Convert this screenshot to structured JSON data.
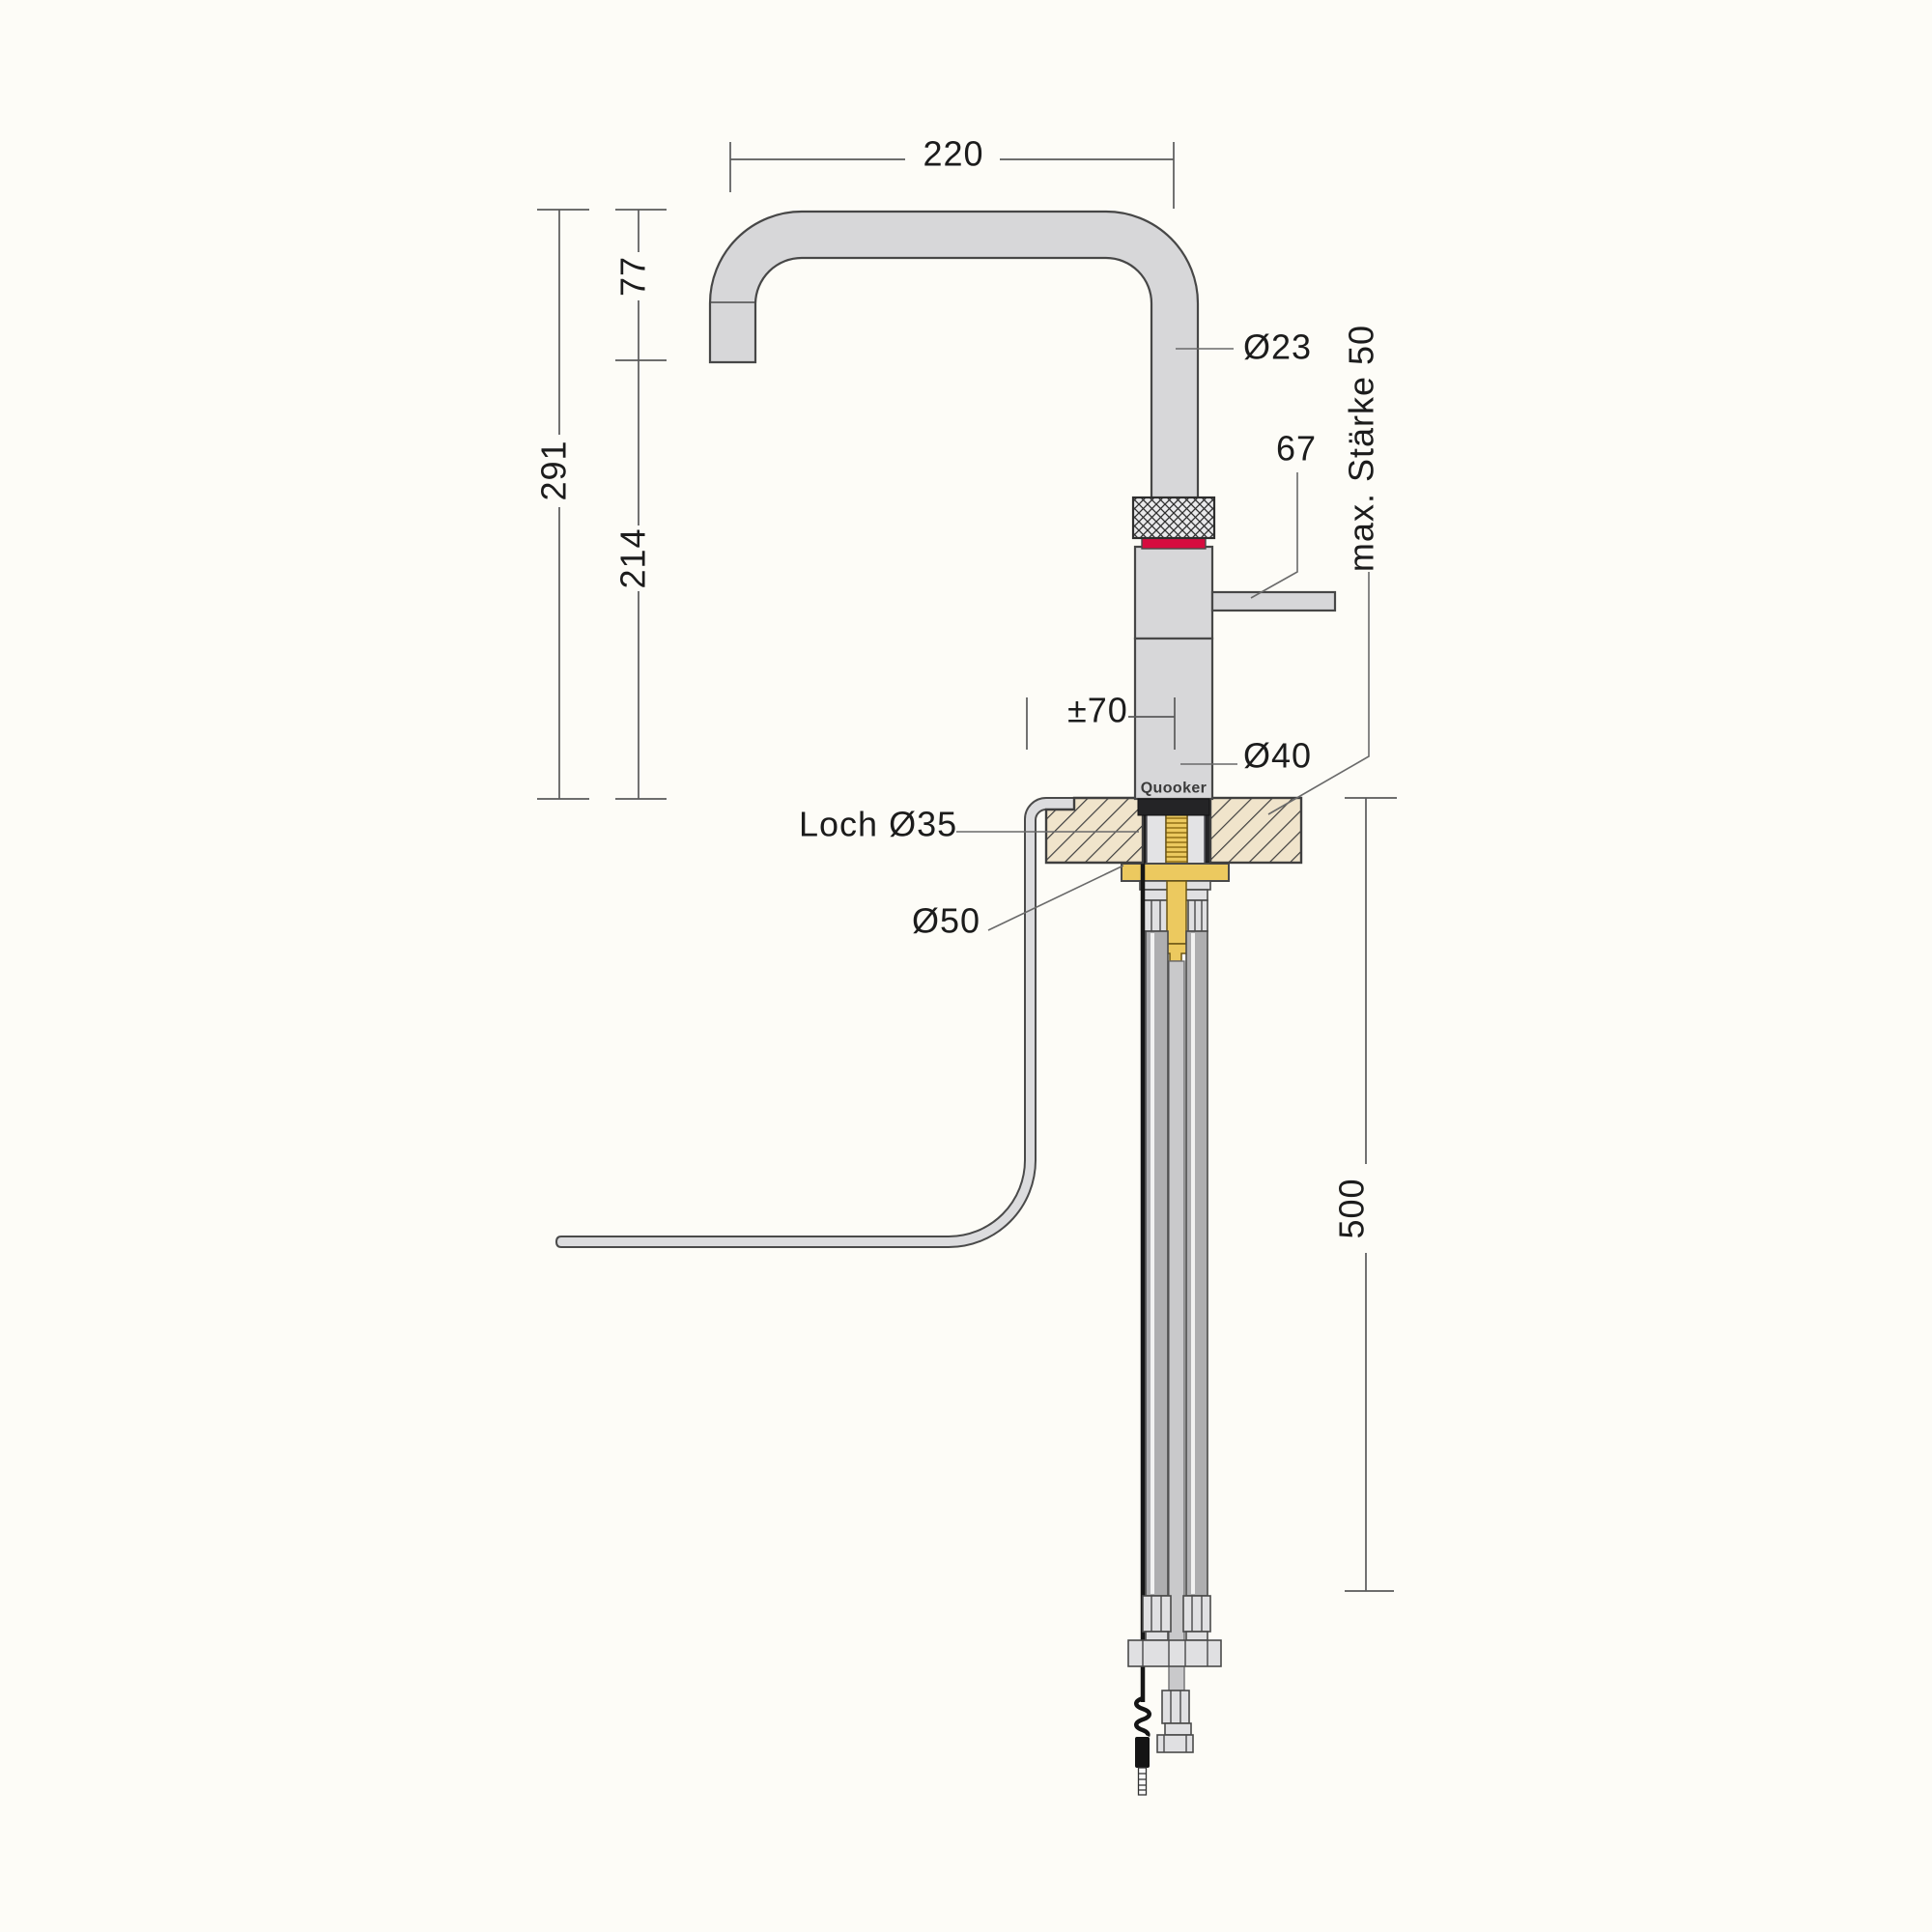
{
  "drawing": {
    "brand": "Quooker",
    "labels": {
      "spout_reach": "220",
      "spout_drop": "77",
      "total_height": "291",
      "under_spout_height": "214",
      "spout_diameter": "Ø23",
      "handle_length": "67",
      "max_counter_thickness": "max. Stärke 50",
      "height_adjust": "±70",
      "body_diameter": "Ø40",
      "hole_diameter": "Loch Ø35",
      "washer_diameter": "Ø50",
      "below_counter_depth": "500"
    },
    "colors": {
      "accent_red": "#d60c3f",
      "brass": "#ecc95f",
      "counter_beige": "#f0e4cb",
      "metal_gray": "#d7d7d9",
      "hose_gray": "#aeaeb0",
      "outline": "#474747"
    }
  }
}
